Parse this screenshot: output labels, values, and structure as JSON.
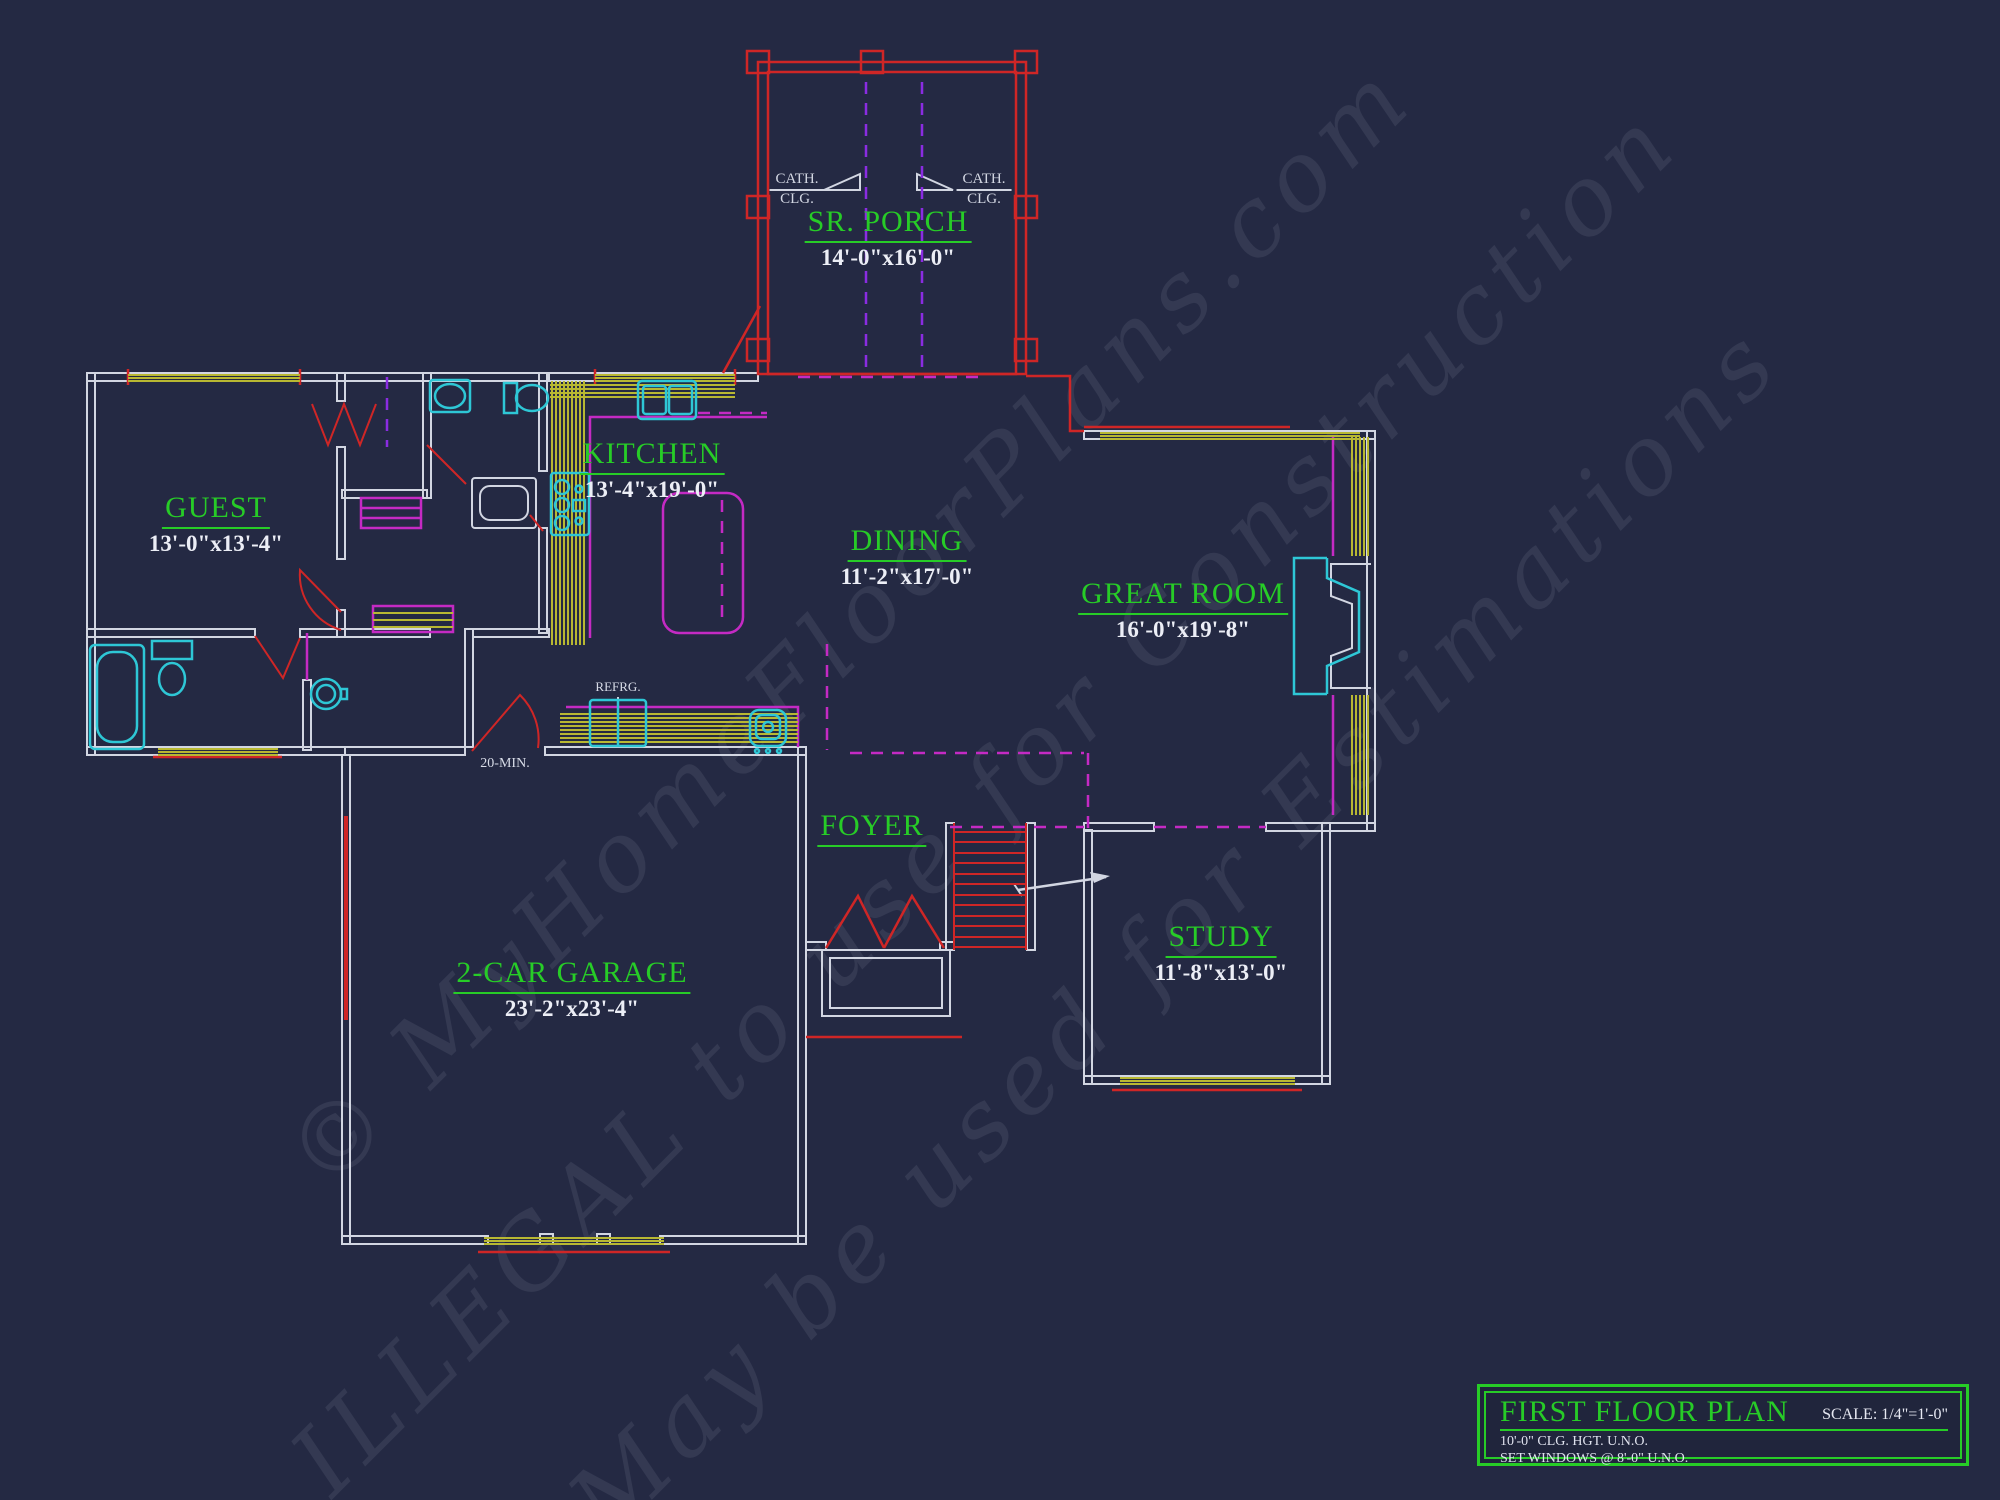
{
  "colors": {
    "background": "#242943",
    "walls": "#d2d6e2",
    "red": "#cf2626",
    "magenta": "#c42ac4",
    "violet": "#8a2ce2",
    "cyan": "#2ec7d6",
    "yellow": "#b8b832",
    "label_green": "#27cc27",
    "text_white": "#eceef6"
  },
  "rooms": {
    "porch": {
      "name": "SR. PORCH",
      "dims": "14'-0\"x16'-0\""
    },
    "guest": {
      "name": "GUEST",
      "dims": "13'-0\"x13'-4\""
    },
    "kitchen": {
      "name": "KITCHEN",
      "dims": "13'-4\"x19'-0\""
    },
    "dining": {
      "name": "DINING",
      "dims": "11'-2\"x17'-0\""
    },
    "great_room": {
      "name": "GREAT ROOM",
      "dims": "16'-0\"x19'-8\""
    },
    "foyer": {
      "name": "FOYER",
      "dims": ""
    },
    "garage": {
      "name": "2-CAR GARAGE",
      "dims": "23'-2\"x23'-4\""
    },
    "study": {
      "name": "STUDY",
      "dims": "11'-8\"x13'-0\""
    }
  },
  "annotations": {
    "cath": "CATH.",
    "clg": "CLG.",
    "refrigerator": "REFRG.",
    "garage_door_rating": "20-MIN."
  },
  "watermark": {
    "line1": "© MyHomeFloorPlans.com",
    "line2": "ILLEGAL to use for Construction",
    "line3": "May be used for Estimations"
  },
  "title_block": {
    "title": "FIRST FLOOR PLAN",
    "scale": "SCALE: 1/4\"=1'-0\"",
    "note1": "10'-0\" CLG. HGT. U.N.O.",
    "note2": "SET WINDOWS @ 8'-0\" U.N.O."
  }
}
